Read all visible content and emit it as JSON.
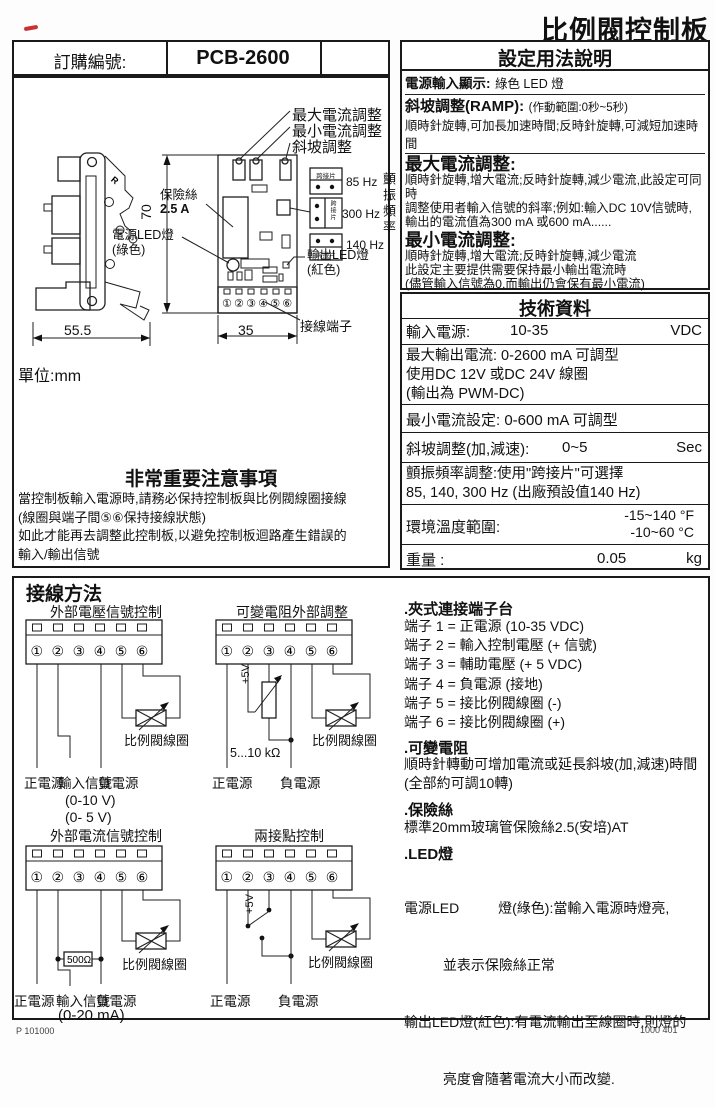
{
  "page": {
    "title": "比例閥控制板",
    "footer_left": "P  101000",
    "footer_right": "1000 401"
  },
  "order": {
    "label": "訂購編號:",
    "value": "PCB-2600"
  },
  "settings": {
    "title": "設定用法說明",
    "power_label": "電源輸入顯示:",
    "power_value": "綠色 LED 燈",
    "ramp_label": "斜坡調整(RAMP):",
    "ramp_note": "(作動範圍:0秒~5秒)",
    "ramp_line": "順時針旋轉,可加長加速時間;反時針旋轉,可減短加速時間",
    "max_title": "最大電流調整:",
    "max_lines": [
      "順時針旋轉,增大電流;反時針旋轉,減少電流,此設定可同時",
      "調整使用者輸入信號的斜率;例如:輸入DC 10V信號時,",
      "輸出的電流值為300 mA 或600 mA......"
    ],
    "min_title": "最小電流調整:",
    "min_lines": [
      "順時針旋轉,增大電流;反時針旋轉,減少電流",
      "此設定主要提供需要保持最小輸出電流時",
      "(儘管輸入信號為0,而輸出仍會保有最小電流)"
    ],
    "dither_title": "顫振頻率調整:",
    "dither_lines": [
      "為了讓比例閥擁有快速的反應速度及減少遲滯,",
      "因此可選擇85, 140, 300Hz等3種頻率",
      "若需要其它頻率或全調型,請與Winner公司洽詢"
    ]
  },
  "tech": {
    "title": "技術資料",
    "row1": {
      "label": "輸入電源:",
      "value": "10-35",
      "unit": "VDC"
    },
    "row2": [
      "最大輸出電流: 0-2600 mA 可調型",
      "使用DC 12V 或DC 24V 線圈",
      "(輸出為 PWM-DC)"
    ],
    "row3": "最小電流設定: 0-600 mA 可調型",
    "row4": {
      "label": "斜坡調整(加,減速):",
      "value": "0~5",
      "unit": "Sec"
    },
    "row5": [
      "顫振頻率調整:使用\"跨接片\"可選擇",
      "85, 140, 300 Hz (出廠預設值140 Hz)"
    ],
    "row6": {
      "label": "環境溫度範圍:",
      "value_f": "-15~140 °F",
      "value_c": "-10~60 °C"
    },
    "row7": {
      "label": "重量 :",
      "value": "0.05",
      "unit": "kg"
    }
  },
  "drawing": {
    "unit": "單位:mm",
    "label_max": "最大電流調整",
    "label_min": "最小電流調整",
    "label_ramp": "斜坡調整",
    "fuse_label": "保險絲",
    "fuse_value": "2.5 A",
    "power_led_label": "電源LED燈",
    "power_led_color": "(綠色)",
    "output_led_label": "輸出LED燈",
    "output_led_color": "(紅色)",
    "terminal_label": "接線端子",
    "jumper_label": "跨接片",
    "freq_85": "85 Hz",
    "freq_300": "300 Hz",
    "freq_140": "140 Hz",
    "dither_vertical": "顫振頻率",
    "dim_height": "70",
    "dim_width": "55.5",
    "dim_pcb": "35",
    "terminals": "①②③④⑤⑥",
    "side_r": "R"
  },
  "notice": {
    "title": "非常重要注意事項",
    "lines": [
      "當控制板輸入電源時,請務必保持控制板與比例閥線圈接線",
      "(線圈與端子間⑤⑥保持接線狀態)",
      "如此才能再去調整此控制板,以避免控制板迴路產生錯誤的",
      "輸入/輸出信號"
    ]
  },
  "wiring": {
    "title": "接線方法",
    "coil": "比例閥線圈",
    "terminals": "①②③④⑤⑥",
    "d1": {
      "title": "外部電壓信號控制",
      "pos": "正電源",
      "sig": "輸入信號",
      "neg": "負電源",
      "range1": "(0-10 V)",
      "range2": "(0- 5 V)"
    },
    "d2": {
      "title": "可變電阻外部調整",
      "pos": "正電源",
      "neg": "負電源",
      "v5": "+5V",
      "pot": "5...10 kΩ"
    },
    "d3": {
      "title": "外部電流信號控制",
      "pos": "正電源",
      "sig": "輸入信號",
      "neg": "負電源",
      "range": "(0-20 mA)",
      "res": "500Ω"
    },
    "d4": {
      "title": "兩接點控制",
      "pos": "正電源",
      "neg": "負電源",
      "v5": "+5V"
    }
  },
  "info": {
    "clamp_title": ".夾式連接端子台",
    "clamp_lines": [
      "端子 1 = 正電源 (10-35 VDC)",
      "端子 2 = 輸入控制電壓 (+ 信號)",
      "端子 3 = 輔助電壓 (+ 5 VDC)",
      "端子 4 = 負電源 (接地)",
      "端子 5 = 接比例閥線圈 (-)",
      "端子 6 = 接比例閥線圈 (+)"
    ],
    "pot_title": ".可變電阻",
    "pot_lines": [
      "順時針轉動可增加電流或延長斜坡(加,減速)時間",
      "(全部約可調10轉)"
    ],
    "fuse_title": ".保險絲",
    "fuse_lines": [
      "標準20mm玻璃管保險絲2.5(安培)AT"
    ],
    "led_title": ".LED燈",
    "led_lines": [
      "電源LED          燈(綠色):當輸入電源時燈亮,",
      "          並表示保險絲正常",
      "輸出LED燈(紅色):有電流輸出至線圈時,則燈的",
      "          亮度會隨著電流大小而改變."
    ]
  }
}
